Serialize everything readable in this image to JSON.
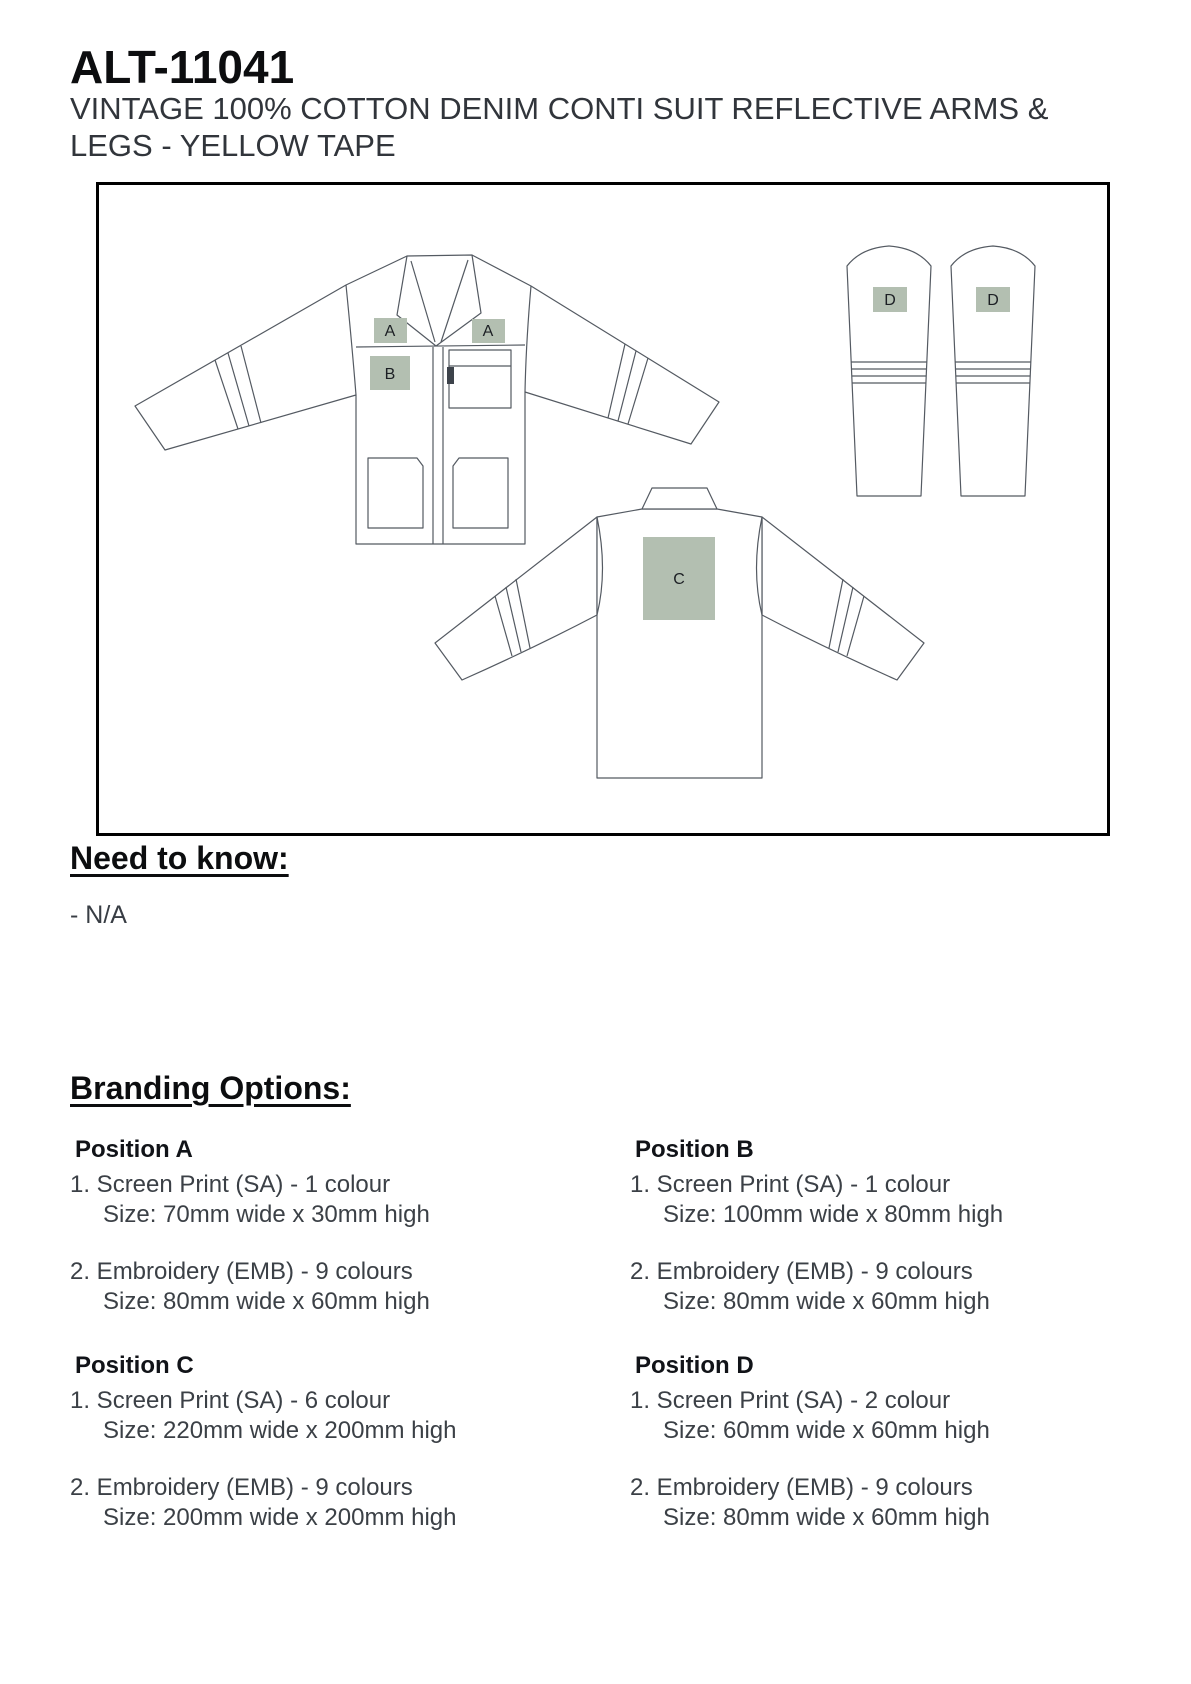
{
  "product": {
    "code": "ALT-11041",
    "description": "VINTAGE 100% COTTON DENIM CONTI SUIT REFLECTIVE ARMS & LEGS - YELLOW TAPE"
  },
  "diagram": {
    "description": "line drawing of conti suit: jacket front view, jacket back view, two trouser legs",
    "front_view": {
      "markers": [
        "A",
        "A",
        "B"
      ]
    },
    "back_view": {
      "markers": [
        "C"
      ]
    },
    "left_leg": {
      "markers": [
        "D"
      ]
    },
    "right_leg": {
      "markers": [
        "D"
      ]
    },
    "colors": {
      "marker_fill": "#b3bfb1",
      "outline": "#545a62",
      "box_border": "#000000"
    }
  },
  "need_to_know": {
    "heading": "Need to know:",
    "items": [
      "- N/A"
    ]
  },
  "branding": {
    "heading": "Branding Options:",
    "positions": [
      {
        "title": "Position A",
        "options": [
          {
            "label": "1. Screen Print (SA) - 1 colour",
            "size": "Size: 70mm wide x 30mm high"
          },
          {
            "label": "2. Embroidery (EMB) - 9 colours",
            "size": "Size: 80mm wide x 60mm high"
          }
        ]
      },
      {
        "title": "Position B",
        "options": [
          {
            "label": "1. Screen Print (SA) - 1 colour",
            "size": "Size: 100mm wide x 80mm high"
          },
          {
            "label": "2. Embroidery (EMB) - 9 colours",
            "size": "Size: 80mm wide x 60mm high"
          }
        ]
      },
      {
        "title": "Position C",
        "options": [
          {
            "label": "1. Screen Print (SA) - 6 colour",
            "size": "Size: 220mm wide x 200mm high"
          },
          {
            "label": "2. Embroidery (EMB) - 9 colours",
            "size": "Size: 200mm wide x 200mm high"
          }
        ]
      },
      {
        "title": "Position D",
        "options": [
          {
            "label": "1. Screen Print (SA) - 2 colour",
            "size": "Size: 60mm wide x 60mm high"
          },
          {
            "label": "2. Embroidery (EMB) - 9 colours",
            "size": "Size: 80mm wide x 60mm high"
          }
        ]
      }
    ]
  }
}
